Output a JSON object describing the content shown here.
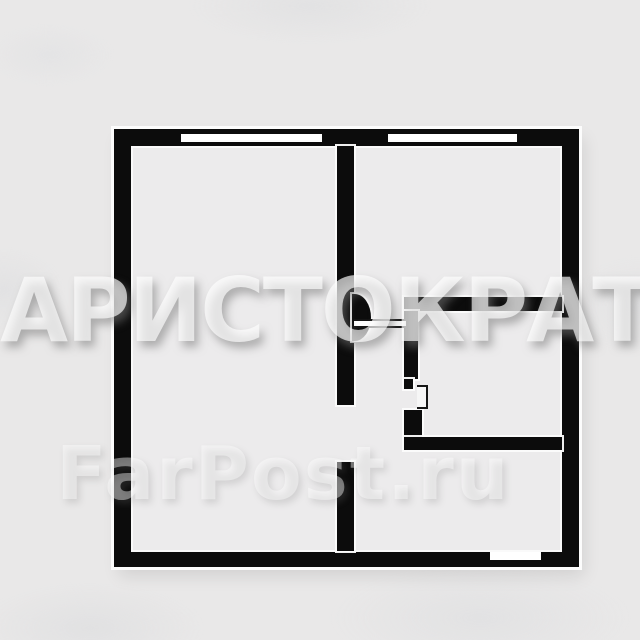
{
  "watermarks": {
    "primary": "АРИСТОКРАТ",
    "secondary": "FarPost.ru"
  },
  "colors": {
    "wall": "#0c0c0c",
    "background": "#e9e8e8",
    "floor": "#ecebec",
    "wall_highlight": "#fcfcfc",
    "watermark": "#ffffff"
  },
  "floorplan": {
    "type": "apartment-floor-plan",
    "features": [
      "outer-wall",
      "window-top-left",
      "window-top-right",
      "divider-wall-with-doorway",
      "kitchen-doorway-with-door-swing",
      "bathroom-with-door-leaf",
      "entrance-notch-bottom-wall"
    ]
  }
}
